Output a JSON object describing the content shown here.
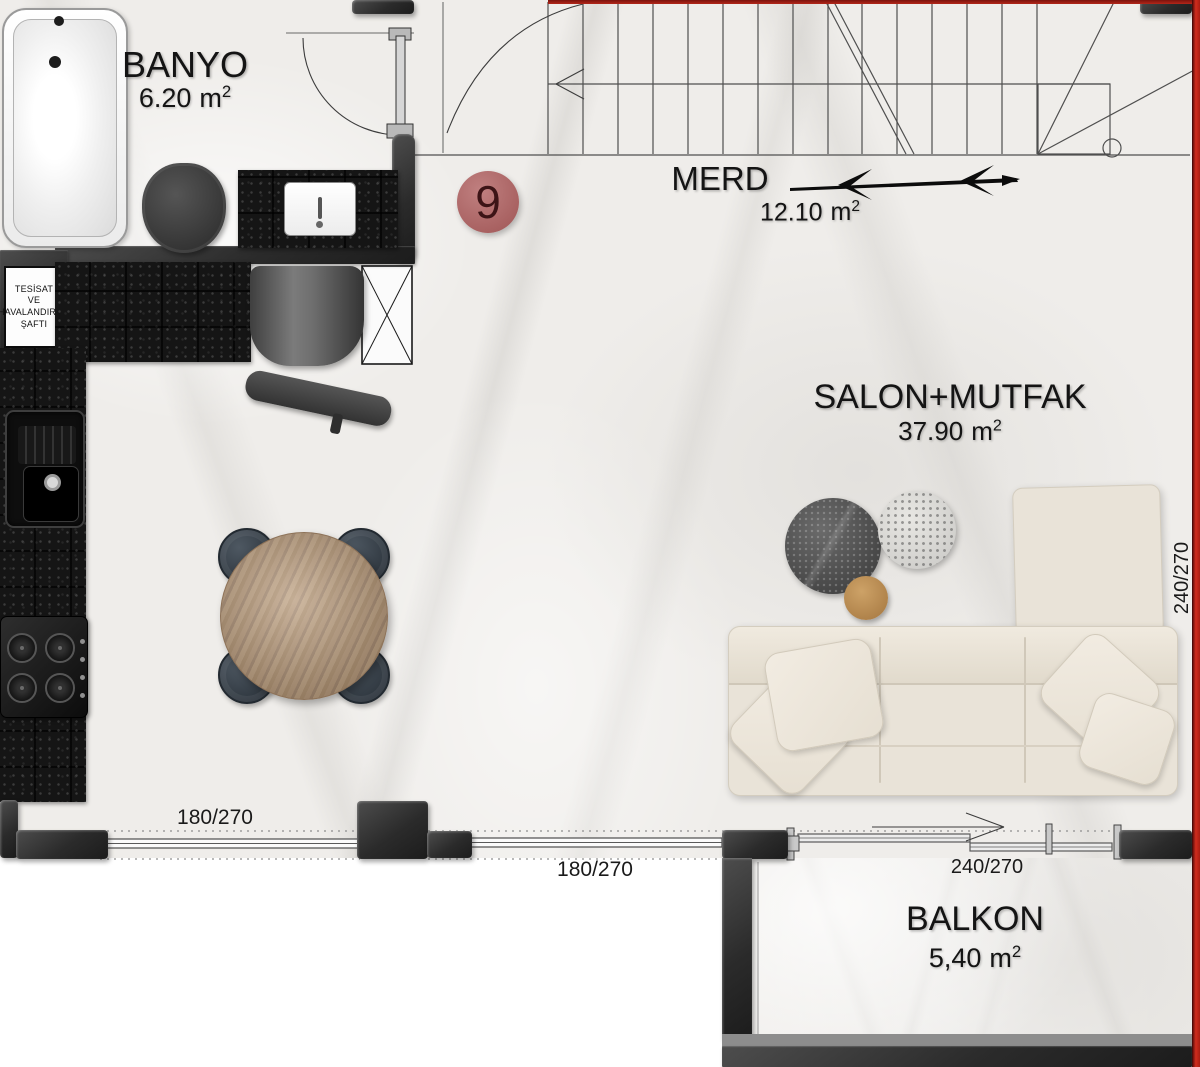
{
  "badge": {
    "number": "9"
  },
  "rooms": {
    "banyo": {
      "name": "BANYO",
      "area": "6.20",
      "unit": "m",
      "sup": "2"
    },
    "merd": {
      "name": "MERD",
      "area": "12.10",
      "unit": "m",
      "sup": "2"
    },
    "salon": {
      "name": "SALON+MUTFAK",
      "area": "37.90",
      "unit": "m",
      "sup": "2"
    },
    "balkon": {
      "name": "BALKON",
      "area": "5,40",
      "unit": "m",
      "sup": "2"
    }
  },
  "shaft": {
    "lines": [
      "TESİSAT",
      "VE",
      "HAVALANDIRMA",
      "ŞAFTI"
    ]
  },
  "dims": {
    "window_left": "180/270",
    "window_mid": "180/270",
    "balcony_door": "240/270",
    "side_wall": "240/270"
  },
  "colors": {
    "accent_wall": "#c0281e",
    "badge_fill": "#b06c6c",
    "wall_dark": "#2c2c2c"
  }
}
